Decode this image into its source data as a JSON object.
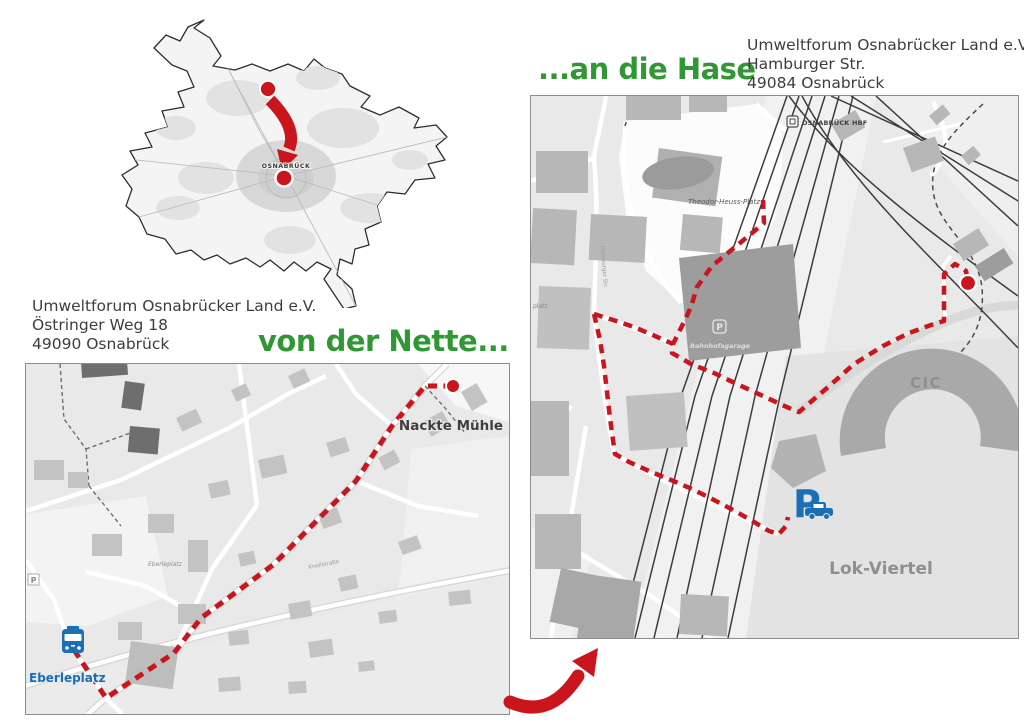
{
  "document": {
    "headings": {
      "nette": "von der Nette...",
      "hase": "...an die Hase"
    },
    "addresses": {
      "nette": {
        "line1": "Umweltforum Osnabrücker Land e.V.",
        "line2": "Östringer Weg 18",
        "line3": "49090 Osnabrück"
      },
      "hase": {
        "line1": "Umweltforum Osnabrücker Land e.V.",
        "line2": "Hamburger Str.",
        "line3": "49084 Osnabrück"
      }
    }
  },
  "overview_map": {
    "city_label": "OSNABRÜCK"
  },
  "left_map": {
    "destination_label": "Nackte Mühle",
    "bus_stop_label": "Eberleplatz",
    "square_label": "Eberleplatz",
    "street_label": "Knollstraße",
    "parking_letter": "P"
  },
  "right_map": {
    "station_label": "OSNABRÜCK HBF",
    "plaza_label": "Theodor-Heuss-Platz",
    "garage_letter": "P",
    "garage_label": "Bahnhofsgarage",
    "cic_label": "CIC",
    "district_label": "Lok-Viertel",
    "parking_letter": "P",
    "street_label": "Hamburger Str.",
    "edge_label": "platz"
  },
  "colors": {
    "route_red": "#c9151b",
    "heading_green": "#2f9733",
    "transit_blue": "#1a6fb5",
    "map_background": "#e9e9e9"
  }
}
